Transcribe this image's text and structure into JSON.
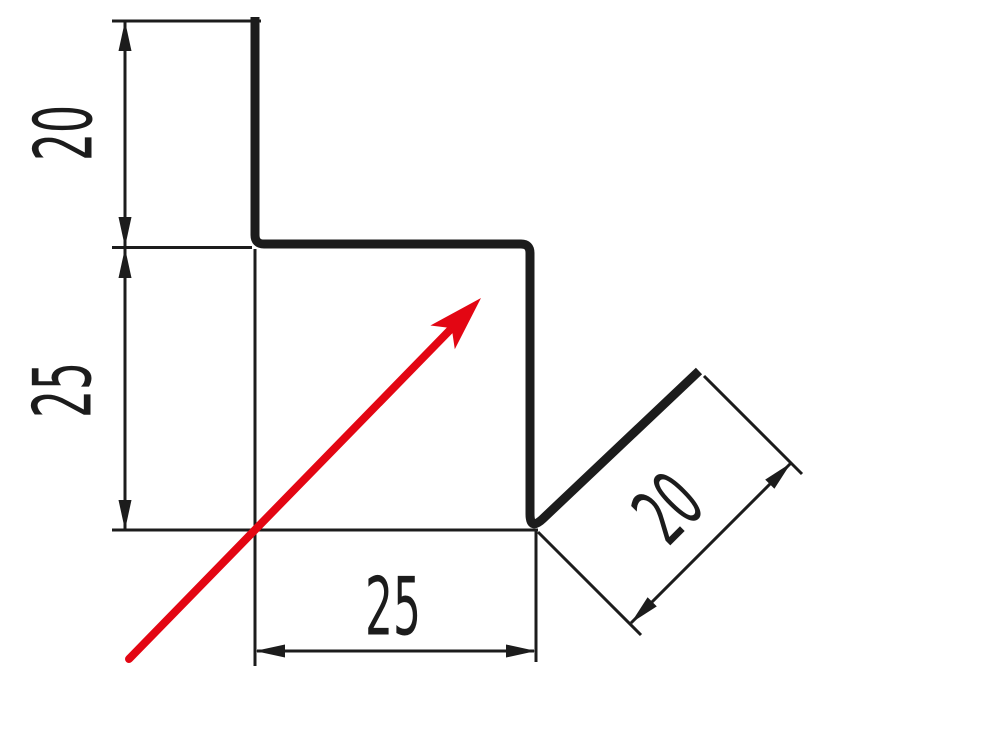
{
  "drawing": {
    "type": "sheet-metal-profile-cross-section",
    "background_color": "#ffffff",
    "line_color": "#1c1c1c",
    "accent_color": "#e30613",
    "dimensions": {
      "top_left": {
        "value": "20",
        "orientation": "vertical"
      },
      "left": {
        "value": "25",
        "orientation": "vertical"
      },
      "bottom": {
        "value": "25",
        "orientation": "horizontal"
      },
      "diagonal": {
        "value": "20",
        "orientation": "diagonal-45"
      }
    }
  }
}
